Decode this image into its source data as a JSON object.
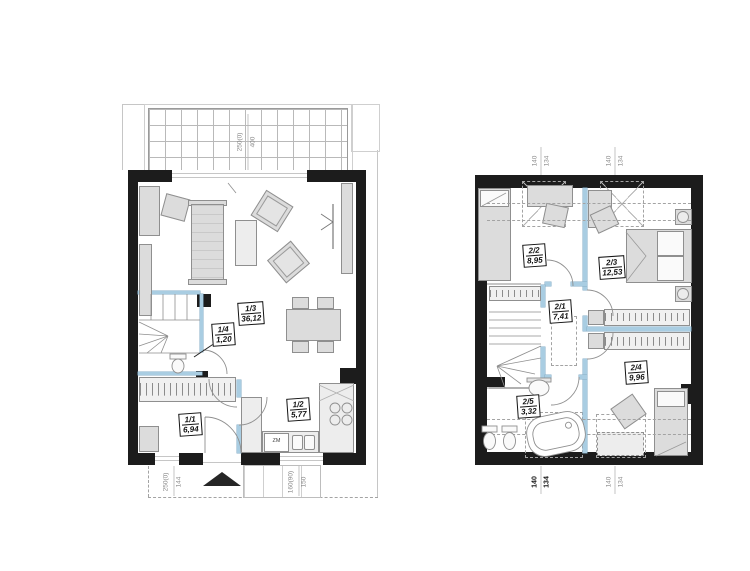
{
  "ground_floor": {
    "rooms": [
      {
        "number": "1/1",
        "area": "6,94"
      },
      {
        "number": "1/2",
        "area": "5,77"
      },
      {
        "number": "1/3",
        "area": "36,12"
      },
      {
        "number": "1/4",
        "area": "1,20"
      }
    ],
    "terrace_dim": {
      "a": "250(0)",
      "b": "400"
    },
    "bottom_dims": [
      {
        "a": "250(0)",
        "b": "144"
      },
      {
        "a": "160(90)",
        "b": "150"
      }
    ],
    "kitchen_label": "ZM"
  },
  "upper_floor": {
    "rooms": [
      {
        "number": "2/1",
        "area": "7,41"
      },
      {
        "number": "2/2",
        "area": "8,95"
      },
      {
        "number": "2/3",
        "area": "12,53"
      },
      {
        "number": "2/4",
        "area": "9,96"
      },
      {
        "number": "2/5",
        "area": "3,32"
      }
    ],
    "top_dims": [
      {
        "a": "140",
        "b": "134"
      },
      {
        "a": "140",
        "b": "134"
      }
    ],
    "bottom_dims": [
      {
        "a": "140",
        "b": "134"
      },
      {
        "a": "140",
        "b": "134"
      }
    ]
  },
  "colors": {
    "wall": "#1c1c1c",
    "partition_accent": "#a9cde2",
    "furniture_fill": "#dcdcdc",
    "line": "#8f8f8f"
  }
}
